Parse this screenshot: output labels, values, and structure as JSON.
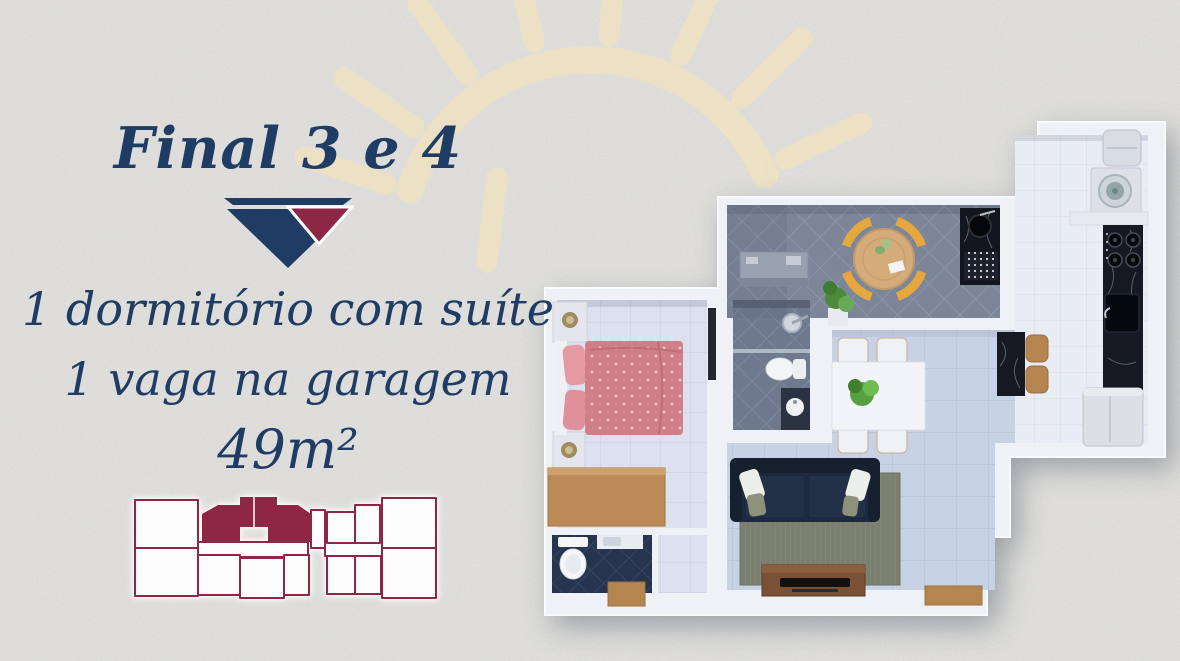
{
  "page": {
    "type": "real-estate-floorplan-flyer"
  },
  "colors": {
    "background": "#eae8e3",
    "navy": "#1e3c64",
    "maroon": "#8e2746",
    "sun": "#f0e2bf",
    "keyplan_white": "#fdfdfe"
  },
  "panel": {
    "title": "Final 3 e 4",
    "features": [
      "1 dormitório com suíte",
      "1 vaga na garagem",
      "49m²"
    ]
  },
  "keyplan": {
    "name": "building-key-plan",
    "outline_color": "#8e2746",
    "highlight_color": "#8e2746"
  },
  "floorplan": {
    "name": "apartment-3d-top-view",
    "rooms": [
      "bedroom-suite",
      "suite-bathroom",
      "social-bathroom",
      "balcony-terrace",
      "dining-area",
      "living-room",
      "kitchen",
      "laundry-area"
    ],
    "furniture": [
      "double-bed",
      "nightstand-lamps",
      "desk",
      "wardrobe",
      "toilet",
      "shower",
      "vanity-sink",
      "round-table",
      "yellow-chairs",
      "gourmet-counter",
      "dish-rack",
      "counter-sink",
      "washing-machine",
      "water-tank",
      "stove-cooktop",
      "kitchen-sink",
      "refrigerator",
      "island-stools",
      "dining-table",
      "dining-chairs",
      "sofa",
      "rug",
      "tv-stand",
      "doormat",
      "plants"
    ],
    "palette": {
      "walls": "#eef1f6",
      "bedroom_floor": "#dbe1ee",
      "balcony_floor": "#7c8698",
      "living_floor": "#c8d2e5",
      "kitchen_floor": "#e8ecf4",
      "suite_bath_floor": "#6e798e",
      "social_bath_floor": "#273450",
      "bed": "#d07e88",
      "sofa": "#1d2a40",
      "wood": "#b5854f",
      "marble": "#141922",
      "chair_yellow": "#e6a73e",
      "rug": "#7b7f70"
    }
  }
}
